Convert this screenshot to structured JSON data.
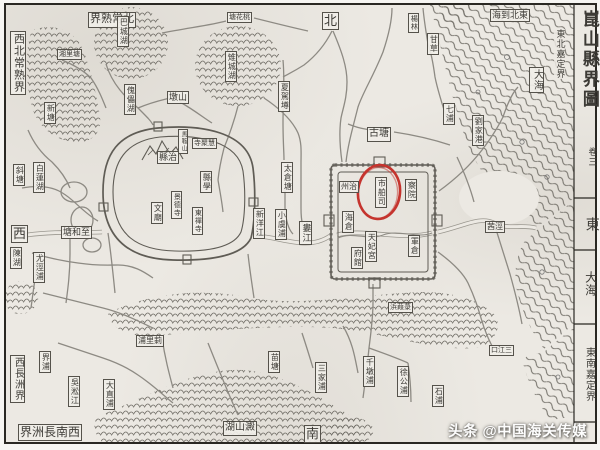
{
  "colors": {
    "paper": "#ece9e3",
    "ink": "#4b4b4b",
    "wall": "#5f5c55",
    "river": "#8d8a83",
    "red_circle": "#c5342e",
    "watermark": "#fdfdfd"
  },
  "watermark": {
    "text": "头条 @中国海关传媒"
  },
  "red_circle": {
    "highlighted_label": "市舶司"
  },
  "map_title": {
    "text": "崑山縣界圖",
    "volume": "卷三"
  },
  "labels": [
    {
      "id": "title",
      "text": "崑山縣界圖",
      "x": 574,
      "y": 5,
      "v": true,
      "boxed": false,
      "fs": 17,
      "cls": "title"
    },
    {
      "id": "title-volume",
      "text": "卷三",
      "x": 581,
      "y": 142,
      "v": true,
      "boxed": false,
      "fs": 9
    },
    {
      "id": "dir-east",
      "text": "東",
      "x": 577,
      "y": 212,
      "v": true,
      "boxed": false,
      "fs": 14
    },
    {
      "id": "east-sea",
      "text": "大海",
      "x": 578,
      "y": 266,
      "v": true,
      "boxed": false,
      "fs": 12
    },
    {
      "id": "border-se",
      "text": "東南嘉定界",
      "x": 576,
      "y": 342,
      "v": true,
      "boxed": false,
      "fs": 10,
      "cls": "plain"
    },
    {
      "id": "border-ne",
      "text": "東北嘉定界",
      "x": 548,
      "y": 24,
      "v": true,
      "boxed": false,
      "fs": 9,
      "cls": "plain"
    },
    {
      "id": "ne-to-sea",
      "text": "海到北東",
      "x": 484,
      "y": 4,
      "v": false,
      "boxed": true,
      "fs": 9
    },
    {
      "id": "dir-north",
      "text": "北",
      "x": 316,
      "y": 7,
      "v": false,
      "boxed": true,
      "fs": 13
    },
    {
      "id": "border-n",
      "text": "界熟常北",
      "x": 82,
      "y": 7,
      "v": false,
      "boxed": true,
      "fs": 11
    },
    {
      "id": "border-nw",
      "text": "西北常熟界",
      "x": 4,
      "y": 26,
      "v": true,
      "boxed": true,
      "fs": 11
    },
    {
      "id": "dir-west",
      "text": "西",
      "x": 5,
      "y": 220,
      "v": false,
      "boxed": true,
      "fs": 13
    },
    {
      "id": "border-sw",
      "text": "西長洲界",
      "x": 4,
      "y": 350,
      "v": true,
      "boxed": true,
      "fs": 10
    },
    {
      "id": "border-s",
      "text": "界洲長南西",
      "x": 12,
      "y": 419,
      "v": false,
      "boxed": true,
      "fs": 12
    },
    {
      "id": "dir-south",
      "text": "南",
      "x": 298,
      "y": 420,
      "v": false,
      "boxed": true,
      "fs": 13
    },
    {
      "id": "sea-box",
      "text": "大海",
      "x": 523,
      "y": 62,
      "v": true,
      "boxed": true,
      "fs": 10
    },
    {
      "id": "ba-lake",
      "text": "巴城湖",
      "x": 111,
      "y": 11,
      "v": true,
      "boxed": true,
      "fs": 8
    },
    {
      "id": "xiangli-tang",
      "text": "湘里塘",
      "x": 51,
      "y": 44,
      "v": false,
      "boxed": true,
      "fs": 7
    },
    {
      "id": "xin-tang",
      "text": "新塘",
      "x": 38,
      "y": 97,
      "v": true,
      "boxed": true,
      "fs": 8
    },
    {
      "id": "kuilei-lake",
      "text": "傀儡湖",
      "x": 118,
      "y": 79,
      "v": true,
      "boxed": true,
      "fs": 8
    },
    {
      "id": "dun-shan",
      "text": "墩山",
      "x": 161,
      "y": 86,
      "v": false,
      "boxed": true,
      "fs": 9
    },
    {
      "id": "zhicheng-lake",
      "text": "雉城湖",
      "x": 219,
      "y": 46,
      "v": true,
      "boxed": true,
      "fs": 8
    },
    {
      "id": "taohua-tang",
      "text": "塘花桃",
      "x": 221,
      "y": 7,
      "v": false,
      "boxed": true,
      "fs": 7
    },
    {
      "id": "xiajia-tang",
      "text": "夏駕墫",
      "x": 272,
      "y": 76,
      "v": true,
      "boxed": true,
      "fs": 8
    },
    {
      "id": "yanglin",
      "text": "楊林",
      "x": 402,
      "y": 8,
      "v": true,
      "boxed": true,
      "fs": 7
    },
    {
      "id": "gancao",
      "text": "甘草",
      "x": 421,
      "y": 28,
      "v": true,
      "boxed": true,
      "fs": 8
    },
    {
      "id": "gu-tang",
      "text": "古塘",
      "x": 361,
      "y": 122,
      "v": false,
      "boxed": true,
      "fs": 10
    },
    {
      "id": "qi-pu",
      "text": "七浦",
      "x": 437,
      "y": 98,
      "v": true,
      "boxed": true,
      "fs": 8
    },
    {
      "id": "liujiagang",
      "text": "劉家港",
      "x": 466,
      "y": 110,
      "v": true,
      "boxed": true,
      "fs": 8
    },
    {
      "id": "qianjing",
      "text": "茜涇",
      "x": 479,
      "y": 216,
      "v": false,
      "boxed": true,
      "fs": 8
    },
    {
      "id": "taicang-tang",
      "text": "太倉塘",
      "x": 275,
      "y": 157,
      "v": true,
      "boxed": true,
      "fs": 8
    },
    {
      "id": "xinyang-river",
      "text": "新洋江",
      "x": 247,
      "y": 203,
      "v": true,
      "boxed": true,
      "fs": 8
    },
    {
      "id": "xiaoyu-pu",
      "text": "小虞浦",
      "x": 269,
      "y": 204,
      "v": true,
      "boxed": true,
      "fs": 8
    },
    {
      "id": "lou-river",
      "text": "婁江",
      "x": 293,
      "y": 216,
      "v": true,
      "boxed": true,
      "fs": 9
    },
    {
      "id": "zhihe-tang",
      "text": "塘和至",
      "x": 55,
      "y": 221,
      "v": false,
      "boxed": true,
      "fs": 9
    },
    {
      "id": "xie-tang",
      "text": "斜塘",
      "x": 7,
      "y": 159,
      "v": true,
      "boxed": true,
      "fs": 8
    },
    {
      "id": "bailian-lake",
      "text": "白蓮湖",
      "x": 27,
      "y": 157,
      "v": true,
      "boxed": true,
      "fs": 8
    },
    {
      "id": "chen-lake",
      "text": "陳湖",
      "x": 4,
      "y": 242,
      "v": true,
      "boxed": true,
      "fs": 8
    },
    {
      "id": "youjing-pu",
      "text": "尤涇浦",
      "x": 27,
      "y": 247,
      "v": true,
      "boxed": true,
      "fs": 8
    },
    {
      "id": "jie-pu",
      "text": "界浦",
      "x": 33,
      "y": 346,
      "v": true,
      "boxed": true,
      "fs": 8
    },
    {
      "id": "wusong-river",
      "text": "吳淞江",
      "x": 62,
      "y": 371,
      "v": true,
      "boxed": true,
      "fs": 8
    },
    {
      "id": "dazhi-pu",
      "text": "大直浦",
      "x": 97,
      "y": 374,
      "v": true,
      "boxed": true,
      "fs": 8
    },
    {
      "id": "cili-pu",
      "text": "浦里莿",
      "x": 130,
      "y": 330,
      "v": false,
      "boxed": true,
      "fs": 8
    },
    {
      "id": "miao-tang",
      "text": "苗塘",
      "x": 262,
      "y": 346,
      "v": true,
      "boxed": true,
      "fs": 8
    },
    {
      "id": "sanjia-pu",
      "text": "三家浦",
      "x": 309,
      "y": 357,
      "v": true,
      "boxed": true,
      "fs": 8
    },
    {
      "id": "dianshan-lake",
      "text": "湖山澱",
      "x": 217,
      "y": 416,
      "v": false,
      "boxed": true,
      "fs": 10
    },
    {
      "id": "qiandun-pu",
      "text": "千墩浦",
      "x": 357,
      "y": 351,
      "v": true,
      "boxed": true,
      "fs": 8
    },
    {
      "id": "xugong-pu",
      "text": "徐公浦",
      "x": 391,
      "y": 361,
      "v": true,
      "boxed": true,
      "fs": 8
    },
    {
      "id": "shi-pu",
      "text": "石浦",
      "x": 426,
      "y": 380,
      "v": true,
      "boxed": true,
      "fs": 8
    },
    {
      "id": "lujia-bang",
      "text": "浜葭菉",
      "x": 382,
      "y": 297,
      "v": false,
      "boxed": true,
      "fs": 7
    },
    {
      "id": "sanjiang-kou",
      "text": "口江三",
      "x": 483,
      "y": 340,
      "v": false,
      "boxed": true,
      "fs": 7
    },
    {
      "id": "maan-shan",
      "text": "馬鞍山",
      "x": 172,
      "y": 124,
      "v": true,
      "boxed": true,
      "fs": 6
    },
    {
      "id": "xian-zhi",
      "text": "縣治",
      "x": 151,
      "y": 146,
      "v": false,
      "boxed": true,
      "fs": 9
    },
    {
      "id": "huiju-si",
      "text": "寺聚慧",
      "x": 186,
      "y": 133,
      "v": false,
      "boxed": true,
      "fs": 7
    },
    {
      "id": "xian-xue",
      "text": "縣學",
      "x": 194,
      "y": 166,
      "v": true,
      "boxed": true,
      "fs": 8
    },
    {
      "id": "jingde-si",
      "text": "景德寺",
      "x": 165,
      "y": 186,
      "v": true,
      "boxed": true,
      "fs": 7
    },
    {
      "id": "wen-miao",
      "text": "文廟",
      "x": 145,
      "y": 197,
      "v": true,
      "boxed": true,
      "fs": 8
    },
    {
      "id": "dongchan-si",
      "text": "東禪寺",
      "x": 186,
      "y": 202,
      "v": true,
      "boxed": true,
      "fs": 7
    },
    {
      "id": "zhou-zhi",
      "text": "州治",
      "x": 333,
      "y": 176,
      "v": false,
      "boxed": true,
      "fs": 8
    },
    {
      "id": "shibosi",
      "text": "市舶司",
      "x": 369,
      "y": 172,
      "v": true,
      "boxed": true,
      "fs": 8
    },
    {
      "id": "cha-yuan",
      "text": "察院",
      "x": 399,
      "y": 174,
      "v": true,
      "boxed": true,
      "fs": 8
    },
    {
      "id": "hai-cang",
      "text": "海倉",
      "x": 336,
      "y": 206,
      "v": true,
      "boxed": true,
      "fs": 8
    },
    {
      "id": "fu-guan",
      "text": "府館",
      "x": 345,
      "y": 242,
      "v": true,
      "boxed": true,
      "fs": 8
    },
    {
      "id": "tianfei-gong",
      "text": "天妃宮",
      "x": 359,
      "y": 226,
      "v": true,
      "boxed": true,
      "fs": 8
    },
    {
      "id": "jun-cang",
      "text": "軍倉",
      "x": 402,
      "y": 230,
      "v": true,
      "boxed": true,
      "fs": 8
    }
  ]
}
